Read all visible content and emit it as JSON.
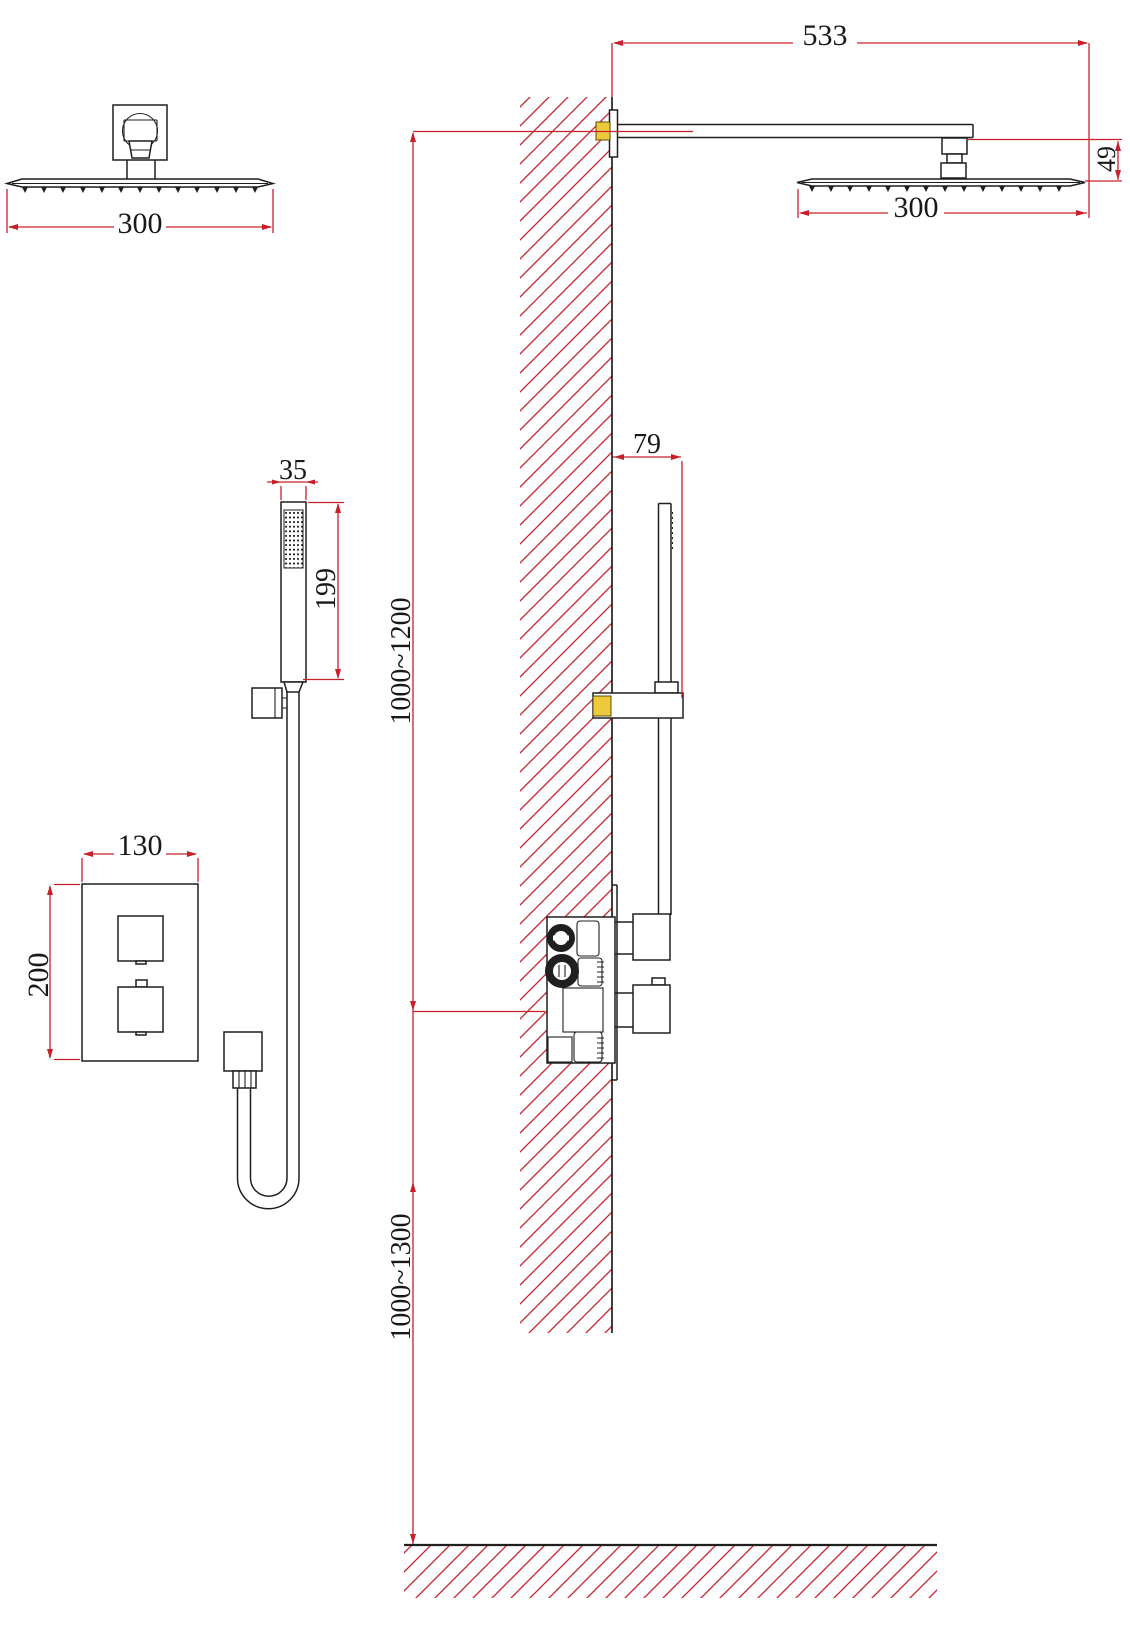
{
  "meta": {
    "kind": "technical installation drawing",
    "subject": "wall-mounted thermostatic rain shower system with hand shower",
    "views": [
      "rain-head front view",
      "arm and rain-head side view",
      "hand-shower front view",
      "slider side view",
      "valve trim front view",
      "valve side view",
      "wall section",
      "floor section"
    ]
  },
  "colors": {
    "dimension_red": "#c8202a",
    "object_black": "#1f1f1f",
    "anchor_yellow": "#edc93c",
    "background": "#ffffff"
  },
  "labels": {
    "front_head_width": "300",
    "arm_reach": "533",
    "head_drop": "49",
    "side_head_width": "300",
    "hand_shower_width": "35",
    "hand_shower_length": "199",
    "slider_depth": "79",
    "valve_plate_width": "130",
    "valve_plate_height": "200",
    "upper_mount_range": "1000~1200",
    "lower_mount_range": "1000~1300"
  }
}
